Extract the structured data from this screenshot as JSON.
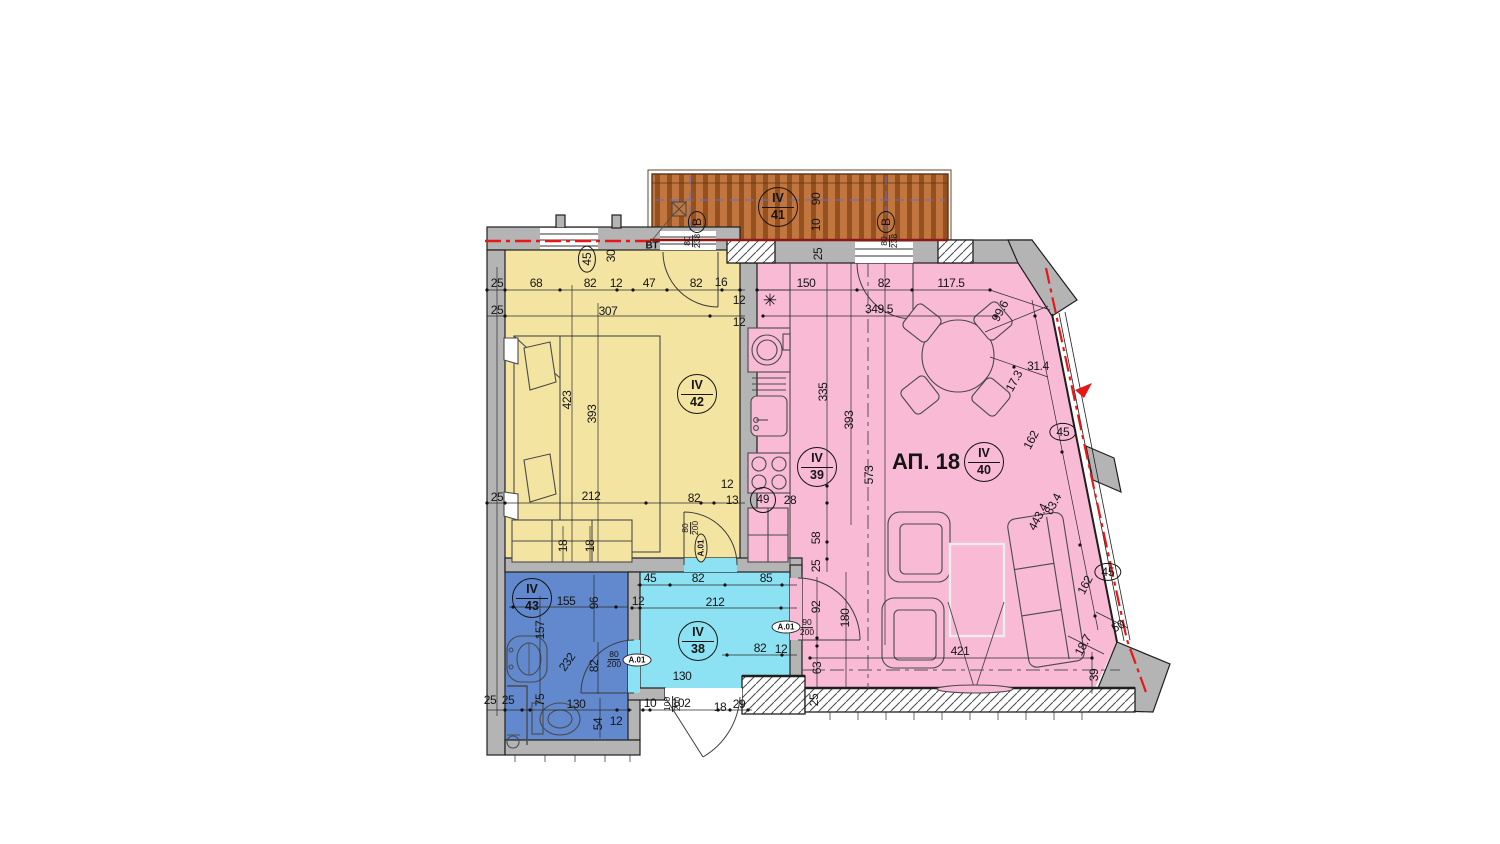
{
  "apartment_label": "АП. 18",
  "colors": {
    "wall": "#b4b4b4",
    "ink": "#1f1f1f",
    "bedroom": "#f4e4a2",
    "living": "#f8bad5",
    "corridor": "#8ce2f3",
    "bathroom": "#6289cd",
    "terrace": "#c1763f",
    "terraceStripe": "#94511f",
    "redline": "#e81717",
    "bluedash": "#5b6fd6"
  },
  "room_tags": [
    {
      "t": "IV",
      "n": "41",
      "x": 778,
      "y": 207
    },
    {
      "t": "IV",
      "n": "42",
      "x": 697,
      "y": 394
    },
    {
      "t": "IV",
      "n": "39",
      "x": 817,
      "y": 467
    },
    {
      "t": "IV",
      "n": "40",
      "x": 984,
      "y": 462
    },
    {
      "t": "IV",
      "n": "38",
      "x": 698,
      "y": 641
    },
    {
      "t": "IV",
      "n": "43",
      "x": 532,
      "y": 598
    }
  ],
  "ellipse_tags": [
    {
      "t": "45",
      "x": 587,
      "y": 259,
      "r": -90
    },
    {
      "t": "45",
      "x": 1063,
      "y": 432,
      "r": 0
    },
    {
      "t": "45",
      "x": 1108,
      "y": 572,
      "r": 0
    },
    {
      "t": "В",
      "x": 697,
      "y": 222,
      "r": -90
    },
    {
      "t": "В",
      "x": 886,
      "y": 222,
      "r": -90
    }
  ],
  "circle_tags": [
    {
      "t": "49",
      "x": 763,
      "y": 500
    }
  ],
  "a01_tags": [
    {
      "t": "A.01",
      "x": 637,
      "y": 660,
      "r": 0,
      "fill": "#ffffff"
    },
    {
      "t": "A.01",
      "x": 786,
      "y": 627,
      "r": 0,
      "fill": "#ffffff"
    },
    {
      "t": "A.01",
      "x": 701,
      "y": 548,
      "r": -90,
      "fill": "#f4e4a2"
    }
  ],
  "size_tags": [
    {
      "top": "80",
      "bot": "200",
      "x": 614,
      "y": 660,
      "r": 0
    },
    {
      "top": "90",
      "bot": "200",
      "x": 807,
      "y": 628,
      "r": 0
    },
    {
      "top": "80",
      "bot": "200",
      "x": 691,
      "y": 528,
      "r": -90
    },
    {
      "top": "100",
      "bot": "200",
      "x": 673,
      "y": 704,
      "r": -90
    },
    {
      "top": "80",
      "bot": "238",
      "x": 693,
      "y": 241,
      "r": -90
    },
    {
      "top": "80",
      "bot": "238",
      "x": 890,
      "y": 241,
      "r": -90
    }
  ],
  "texts": [
    {
      "t": "ВТ",
      "x": 652,
      "y": 246,
      "cls": "bt"
    },
    {
      "t": "АП. 18",
      "x": 926,
      "y": 462,
      "cls": "apt"
    }
  ],
  "glyphs": [
    {
      "t": "✳",
      "x": 770,
      "y": 301
    }
  ],
  "dim_labels": [
    {
      "t": "25",
      "x": 497,
      "y": 283
    },
    {
      "t": "68",
      "x": 536,
      "y": 283
    },
    {
      "t": "82",
      "x": 590,
      "y": 283
    },
    {
      "t": "12",
      "x": 616,
      "y": 283
    },
    {
      "t": "47",
      "x": 649,
      "y": 283
    },
    {
      "t": "82",
      "x": 696,
      "y": 283
    },
    {
      "t": "16",
      "x": 721,
      "y": 282
    },
    {
      "t": "25",
      "x": 497,
      "y": 310
    },
    {
      "t": "307",
      "x": 608,
      "y": 311
    },
    {
      "t": "12",
      "x": 739,
      "y": 300
    },
    {
      "t": "12",
      "x": 739,
      "y": 322
    },
    {
      "t": "30",
      "x": 611,
      "y": 256,
      "r": -90
    },
    {
      "t": "423",
      "x": 567,
      "y": 400,
      "r": -90
    },
    {
      "t": "393",
      "x": 592,
      "y": 414,
      "r": -90
    },
    {
      "t": "25",
      "x": 497,
      "y": 497
    },
    {
      "t": "212",
      "x": 591,
      "y": 496
    },
    {
      "t": "82",
      "x": 694,
      "y": 498
    },
    {
      "t": "13",
      "x": 732,
      "y": 500
    },
    {
      "t": "12",
      "x": 727,
      "y": 484
    },
    {
      "t": "18",
      "x": 563,
      "y": 546,
      "r": -90
    },
    {
      "t": "18",
      "x": 590,
      "y": 546,
      "r": -90
    },
    {
      "t": "150",
      "x": 806,
      "y": 283
    },
    {
      "t": "82",
      "x": 884,
      "y": 283
    },
    {
      "t": "117.5",
      "x": 951,
      "y": 283
    },
    {
      "t": "349.5",
      "x": 879,
      "y": 309
    },
    {
      "t": "99.6",
      "x": 1000,
      "y": 311,
      "r": -62
    },
    {
      "t": "31.4",
      "x": 1038,
      "y": 366
    },
    {
      "t": "17.3",
      "x": 1014,
      "y": 381,
      "r": -62
    },
    {
      "t": "162",
      "x": 1031,
      "y": 440,
      "r": -62
    },
    {
      "t": "83.4",
      "x": 1053,
      "y": 504,
      "r": -62
    },
    {
      "t": "443.4",
      "x": 1038,
      "y": 517,
      "r": -62
    },
    {
      "t": "162",
      "x": 1085,
      "y": 585,
      "r": -62
    },
    {
      "t": "50",
      "x": 1118,
      "y": 626,
      "r": -30
    },
    {
      "t": "18.7",
      "x": 1083,
      "y": 645,
      "r": -62
    },
    {
      "t": "39",
      "x": 1094,
      "y": 675,
      "r": -90
    },
    {
      "t": "421",
      "x": 960,
      "y": 651
    },
    {
      "t": "573",
      "x": 869,
      "y": 475,
      "r": -90
    },
    {
      "t": "393",
      "x": 849,
      "y": 420,
      "r": -90
    },
    {
      "t": "335",
      "x": 823,
      "y": 392,
      "r": -90
    },
    {
      "t": "58",
      "x": 816,
      "y": 538,
      "r": -90
    },
    {
      "t": "25",
      "x": 816,
      "y": 566,
      "r": -90
    },
    {
      "t": "180",
      "x": 845,
      "y": 618,
      "r": -90
    },
    {
      "t": "28",
      "x": 790,
      "y": 500
    },
    {
      "t": "45",
      "x": 650,
      "y": 578
    },
    {
      "t": "82",
      "x": 698,
      "y": 578
    },
    {
      "t": "85",
      "x": 766,
      "y": 578
    },
    {
      "t": "12",
      "x": 638,
      "y": 601
    },
    {
      "t": "212",
      "x": 715,
      "y": 602
    },
    {
      "t": "82",
      "x": 760,
      "y": 648
    },
    {
      "t": "12",
      "x": 781,
      "y": 649
    },
    {
      "t": "92",
      "x": 816,
      "y": 607,
      "r": -90
    },
    {
      "t": "63",
      "x": 817,
      "y": 668,
      "r": -90
    },
    {
      "t": "130",
      "x": 682,
      "y": 676
    },
    {
      "t": "10",
      "x": 650,
      "y": 703
    },
    {
      "t": "102",
      "x": 681,
      "y": 703
    },
    {
      "t": "18",
      "x": 720,
      "y": 707
    },
    {
      "t": "29",
      "x": 739,
      "y": 704
    },
    {
      "t": "155",
      "x": 566,
      "y": 601
    },
    {
      "t": "96",
      "x": 594,
      "y": 603,
      "r": -90
    },
    {
      "t": "157",
      "x": 540,
      "y": 630,
      "r": -90
    },
    {
      "t": "232",
      "x": 567,
      "y": 662,
      "r": -55
    },
    {
      "t": "82",
      "x": 594,
      "y": 666,
      "r": -90
    },
    {
      "t": "25",
      "x": 490,
      "y": 700
    },
    {
      "t": "25",
      "x": 508,
      "y": 700
    },
    {
      "t": "75",
      "x": 540,
      "y": 700,
      "r": -90
    },
    {
      "t": "130",
      "x": 576,
      "y": 704
    },
    {
      "t": "54",
      "x": 598,
      "y": 724,
      "r": -90
    },
    {
      "t": "12",
      "x": 616,
      "y": 721
    },
    {
      "t": "25",
      "x": 818,
      "y": 254,
      "r": -90
    },
    {
      "t": "25",
      "x": 814,
      "y": 700,
      "r": -90
    },
    {
      "t": "90",
      "x": 816,
      "y": 199,
      "r": -90
    },
    {
      "t": "10",
      "x": 816,
      "y": 225,
      "r": -90
    }
  ]
}
